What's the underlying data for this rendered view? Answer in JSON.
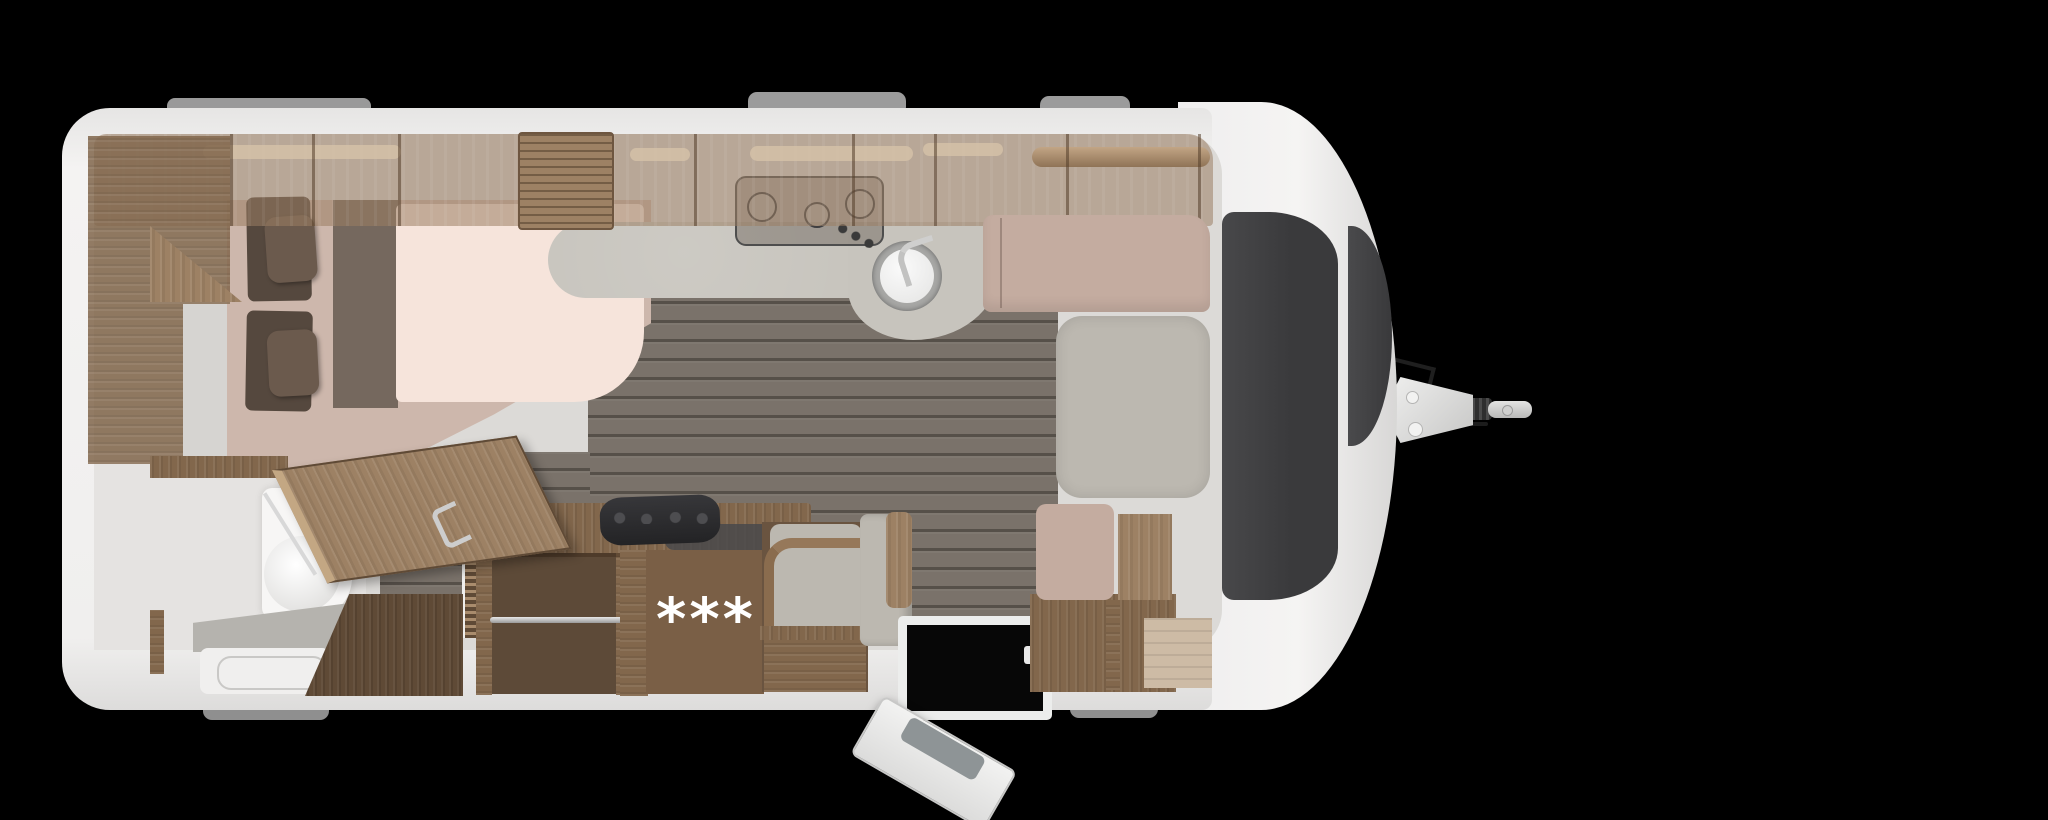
{
  "scene": {
    "description": "caravan floor plan top view",
    "annotation": {
      "badge": "***"
    }
  },
  "colors": {
    "background": "#000000",
    "body-white": "#f0efee",
    "wall-shade": "#d9d8d6",
    "interior": "#dcdad7",
    "wood-medium": "#82674c",
    "wood-light": "#9d8164",
    "wood-dark": "#5f4a36",
    "floor": "#7a726a",
    "counter": "#c7c4bd",
    "mattress": "#f6e4db",
    "bed-base": "#cdb7ac",
    "runner": "#6e6157",
    "pillow": "#55483e",
    "pillow-top": "#6b5a4d",
    "cushion-gray": "#bcb8b0",
    "cushion-beige": "#c4aca0",
    "panel-charcoal": "#3d3d3f",
    "toilet-white": "#f7f6f5",
    "tray-gray": "#b5b3ae",
    "metal": "#c6c6c6",
    "badge": "#ffffff"
  }
}
